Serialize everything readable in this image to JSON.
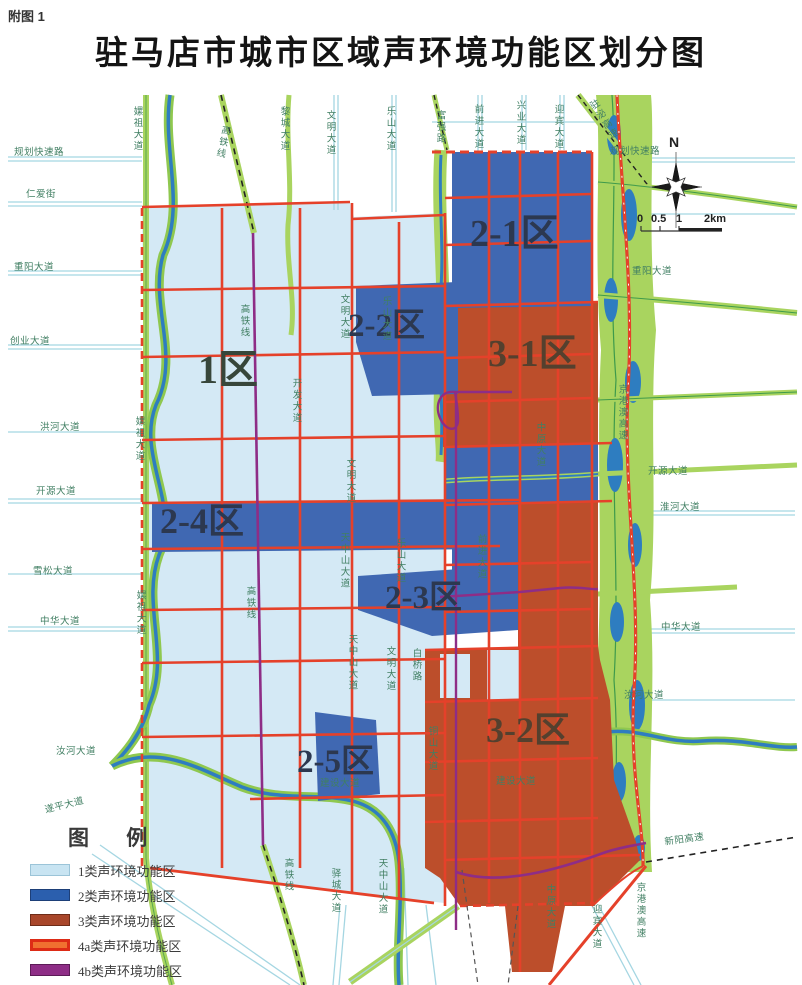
{
  "header": {
    "tag": "附图 1",
    "title": "驻马店市城市区域声环境功能区划分图"
  },
  "compass": {
    "north": "N"
  },
  "scalebar": {
    "t0": "0",
    "t1": "0.5",
    "t2": "1",
    "t3": "2km"
  },
  "legend": {
    "title": "图  例",
    "items": [
      {
        "label": "1类声环境功能区",
        "color": "#c8e4f2",
        "border": "#9bc4d8"
      },
      {
        "label": "2类声环境功能区",
        "color": "#2b5fae",
        "border": "#1d3f78"
      },
      {
        "label": "3类声环境功能区",
        "color": "#a8462a",
        "border": "#6e2c18"
      },
      {
        "label": "4a类声环境功能区",
        "color": "#f07030",
        "border": "#dd2b16",
        "thick": true
      },
      {
        "label": "4b类声环境功能区",
        "color": "#8e2d86",
        "border": "#5c1b57"
      }
    ]
  },
  "map_colors": {
    "zone1_fill": "#d4e9f5",
    "zone2_fill": "#4068b2",
    "zone3_fill": "#bc4e2b",
    "road_4a_red": "#e5412a",
    "rail_4b_purple": "#8e2d86",
    "green_corridor": "#a9d45f",
    "river_blue": "#2e7dc0",
    "cyan_road": "#a5d6e2"
  },
  "zones": [
    {
      "id": "1",
      "label": "1区",
      "x": 198,
      "y": 350,
      "size": 40,
      "color": "#37463a"
    },
    {
      "id": "2-1",
      "label": "2-1区",
      "x": 470,
      "y": 215,
      "size": 38,
      "color": "#2c3850"
    },
    {
      "id": "2-2",
      "label": "2-2区",
      "x": 348,
      "y": 310,
      "size": 33,
      "color": "#2c3850"
    },
    {
      "id": "2-3",
      "label": "2-3区",
      "x": 385,
      "y": 582,
      "size": 33,
      "color": "#2c3850"
    },
    {
      "id": "2-4",
      "label": "2-4区",
      "x": 160,
      "y": 503,
      "size": 36,
      "color": "#2c3850"
    },
    {
      "id": "2-5",
      "label": "2-5区",
      "x": 297,
      "y": 746,
      "size": 33,
      "color": "#2c3850"
    },
    {
      "id": "3-1",
      "label": "3-1区",
      "x": 488,
      "y": 335,
      "size": 38,
      "color": "#54402e"
    },
    {
      "id": "3-2",
      "label": "3-2区",
      "x": 486,
      "y": 712,
      "size": 36,
      "color": "#54402e"
    }
  ],
  "road_labels": [
    {
      "t": "规划快速路",
      "x": 14,
      "y": 148
    },
    {
      "t": "仁爱街",
      "x": 26,
      "y": 190
    },
    {
      "t": "重阳大道",
      "x": 14,
      "y": 263
    },
    {
      "t": "创业大道",
      "x": 10,
      "y": 337
    },
    {
      "t": "洪河大道",
      "x": 40,
      "y": 423
    },
    {
      "t": "开源大道",
      "x": 36,
      "y": 487
    },
    {
      "t": "雪松大道",
      "x": 33,
      "y": 567
    },
    {
      "t": "中华大道",
      "x": 40,
      "y": 617
    },
    {
      "t": "汝河大道",
      "x": 56,
      "y": 747
    },
    {
      "t": "遂平大道",
      "x": 44,
      "y": 806,
      "r": -14
    },
    {
      "t": "规划快速路",
      "x": 610,
      "y": 147
    },
    {
      "t": "重阳大道",
      "x": 632,
      "y": 267
    },
    {
      "t": "开源大道",
      "x": 648,
      "y": 467
    },
    {
      "t": "淮河大道",
      "x": 660,
      "y": 503
    },
    {
      "t": "中华大道",
      "x": 661,
      "y": 623
    },
    {
      "t": "汝河大道",
      "x": 624,
      "y": 691
    },
    {
      "t": "新阳高速",
      "x": 664,
      "y": 838,
      "r": -8
    },
    {
      "t": "建设大道",
      "x": 320,
      "y": 779
    },
    {
      "t": "建设大道",
      "x": 496,
      "y": 777
    },
    {
      "t": "嫘祖大道",
      "x": 131,
      "y": 106,
      "v": 1
    },
    {
      "t": "高铁线",
      "x": 220,
      "y": 124,
      "v": 1,
      "r": 12
    },
    {
      "t": "黎城大道",
      "x": 278,
      "y": 106,
      "v": 1
    },
    {
      "t": "文明大道",
      "x": 324,
      "y": 110,
      "v": 1
    },
    {
      "t": "乐山大道",
      "x": 384,
      "y": 106,
      "v": 1
    },
    {
      "t": "富强路",
      "x": 434,
      "y": 110,
      "v": 1
    },
    {
      "t": "前进大道",
      "x": 472,
      "y": 104,
      "v": 1
    },
    {
      "t": "兴业大道",
      "x": 514,
      "y": 100,
      "v": 1
    },
    {
      "t": "迎宾大道",
      "x": 552,
      "y": 104,
      "v": 1
    },
    {
      "t": "驻泌高速",
      "x": 586,
      "y": 104,
      "v": 1,
      "r": -32
    },
    {
      "t": "嫘祖大道",
      "x": 133,
      "y": 416,
      "v": 1
    },
    {
      "t": "嫘祖大道",
      "x": 134,
      "y": 590,
      "v": 1
    },
    {
      "t": "高铁线",
      "x": 238,
      "y": 304,
      "v": 1
    },
    {
      "t": "高铁线",
      "x": 244,
      "y": 586,
      "v": 1
    },
    {
      "t": "开发大道",
      "x": 290,
      "y": 378,
      "v": 1
    },
    {
      "t": "文明大道",
      "x": 338,
      "y": 294,
      "v": 1
    },
    {
      "t": "乐山大道",
      "x": 380,
      "y": 296,
      "v": 1
    },
    {
      "t": "文明大道",
      "x": 344,
      "y": 458,
      "v": 1
    },
    {
      "t": "天中山大道",
      "x": 338,
      "y": 532,
      "v": 1
    },
    {
      "t": "乐山大道",
      "x": 394,
      "y": 538,
      "v": 1
    },
    {
      "t": "前进大道",
      "x": 475,
      "y": 534,
      "v": 1
    },
    {
      "t": "白桥路",
      "x": 410,
      "y": 648,
      "v": 1
    },
    {
      "t": "天中山大道",
      "x": 346,
      "y": 634,
      "v": 1
    },
    {
      "t": "文明大道",
      "x": 384,
      "y": 646,
      "v": 1
    },
    {
      "t": "铜山大道",
      "x": 426,
      "y": 726,
      "v": 1
    },
    {
      "t": "中原大道",
      "x": 534,
      "y": 422,
      "v": 1
    },
    {
      "t": "京港澳高速",
      "x": 616,
      "y": 384,
      "v": 1
    },
    {
      "t": "迎宾大道",
      "x": 590,
      "y": 904,
      "v": 1
    },
    {
      "t": "京港澳高速",
      "x": 634,
      "y": 882,
      "v": 1
    },
    {
      "t": "高铁线",
      "x": 282,
      "y": 858,
      "v": 1
    },
    {
      "t": "驿城大道",
      "x": 329,
      "y": 868,
      "v": 1
    },
    {
      "t": "天中山大道",
      "x": 376,
      "y": 858,
      "v": 1
    },
    {
      "t": "中原大道",
      "x": 544,
      "y": 884,
      "v": 1
    }
  ]
}
